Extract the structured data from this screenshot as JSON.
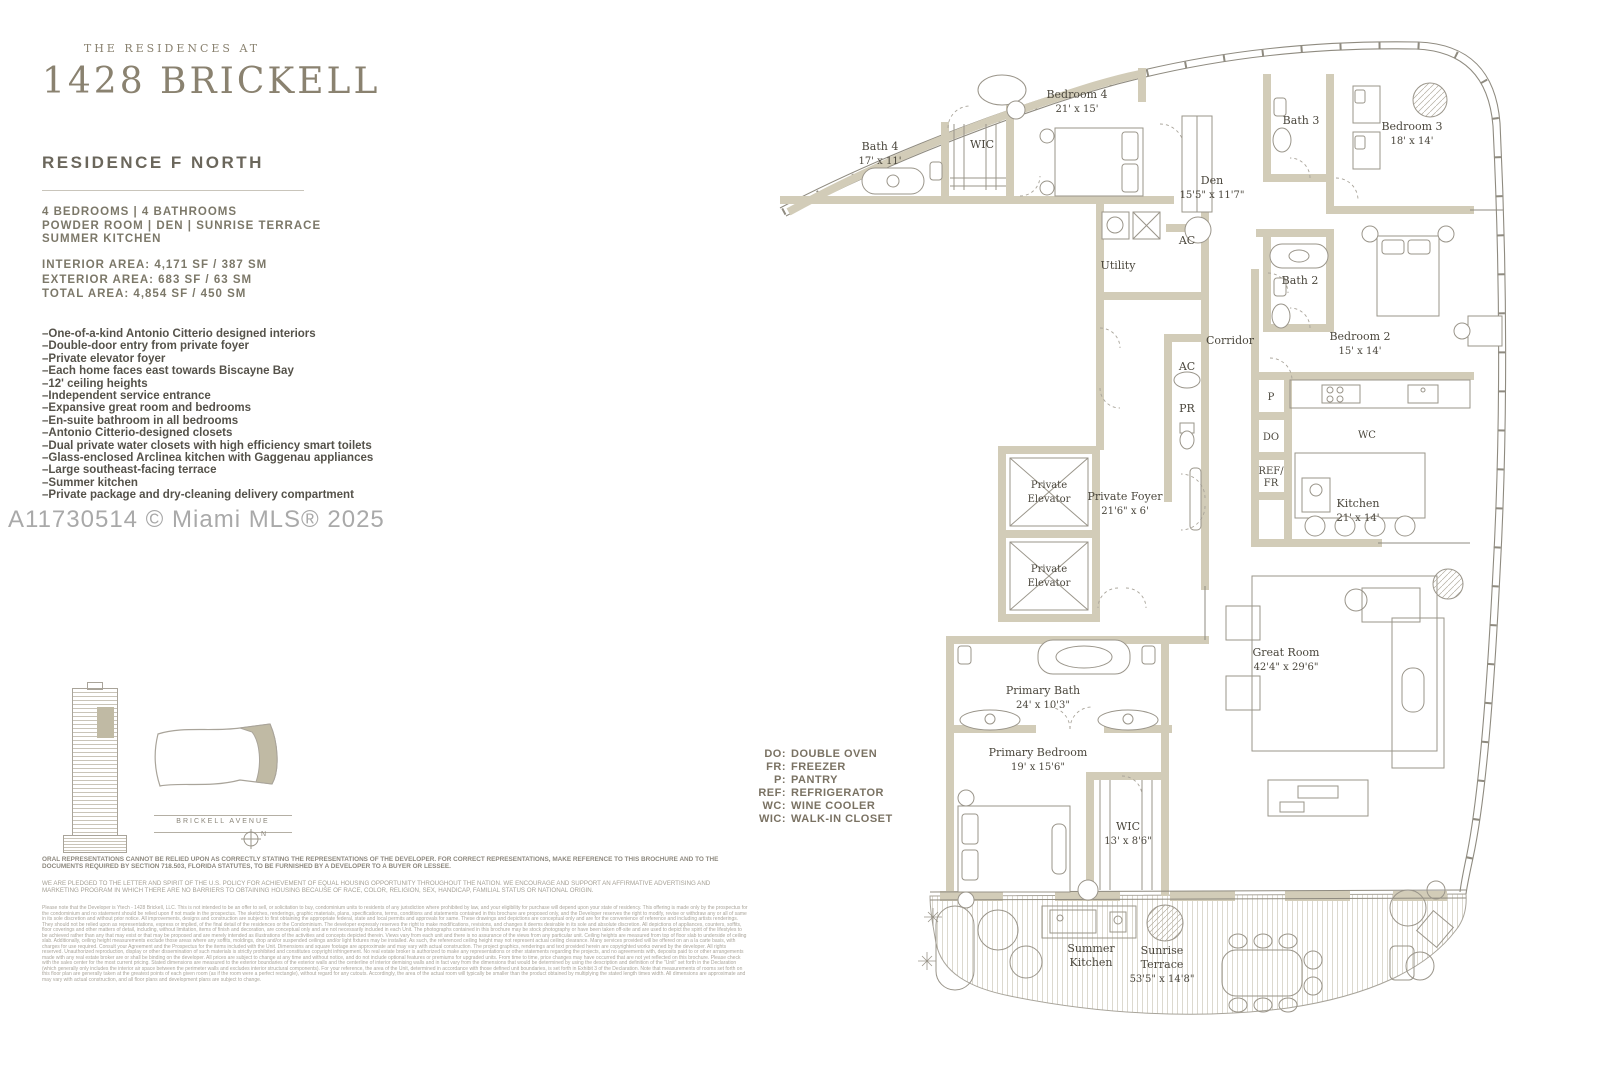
{
  "header": {
    "brand_top": "THE RESIDENCES AT",
    "brand_name": "1428 BRICKELL",
    "residence": "RESIDENCE F NORTH",
    "config_line1": "4 BEDROOMS   |   4 BATHROOMS",
    "config_line2": "POWDER ROOM   |   DEN   |   SUNRISE TERRACE",
    "config_line3": "SUMMER KITCHEN",
    "area_line1": "INTERIOR AREA: 4,171 SF / 387 SM",
    "area_line2": "EXTERIOR AREA: 683 SF / 63 SM",
    "area_line3": "TOTAL AREA: 4,854 SF / 450 SM"
  },
  "features": [
    "–One-of-a-kind Antonio Citterio designed interiors",
    "–Double-door entry from private foyer",
    "–Private elevator foyer",
    "–Each home faces east towards Biscayne Bay",
    "–12' ceiling heights",
    "–Independent service entrance",
    "–Expansive great room and bedrooms",
    "–En-suite bathroom in all bedrooms",
    "–Antonio Citterio-designed closets",
    "–Dual private water closets with high efficiency smart toilets",
    "–Glass-enclosed Arclinea kitchen with Gaggenau appliances",
    "–Large southeast-facing terrace",
    "–Summer kitchen",
    "–Private package and dry-cleaning delivery compartment"
  ],
  "watermark": "A11730514 © Miami MLS® 2025",
  "key_plan": {
    "street": "BRICKELL AVENUE",
    "compass": "N"
  },
  "legend": {
    "items": [
      {
        "abbr": "DO:",
        "label": "DOUBLE OVEN"
      },
      {
        "abbr": "FR:",
        "label": "FREEZER"
      },
      {
        "abbr": "P:",
        "label": "PANTRY"
      },
      {
        "abbr": "REF:",
        "label": "REFRIGERATOR"
      },
      {
        "abbr": "WC:",
        "label": "WINE COOLER"
      },
      {
        "abbr": "WIC:",
        "label": "WALK-IN CLOSET"
      }
    ]
  },
  "plan": {
    "rooms": {
      "bath4": {
        "name": "Bath 4",
        "dims": "17' x 11'"
      },
      "wic4": {
        "name": "WIC"
      },
      "bedroom4": {
        "name": "Bedroom 4",
        "dims": "21' x 15'"
      },
      "den": {
        "name": "Den",
        "dims": "15'5\" x 11'7\""
      },
      "bath3": {
        "name": "Bath 3"
      },
      "bedroom3": {
        "name": "Bedroom 3",
        "dims": "18' x 14'"
      },
      "utility": {
        "name": "Utility"
      },
      "ac1": {
        "name": "AC"
      },
      "bath2": {
        "name": "Bath 2"
      },
      "bedroom2": {
        "name": "Bedroom 2",
        "dims": "15' x 14'"
      },
      "corridor": {
        "name": "Corridor"
      },
      "ac2": {
        "name": "AC"
      },
      "pr": {
        "name": "PR"
      },
      "elev1": {
        "line1": "Private",
        "line2": "Elevator"
      },
      "elev2": {
        "line1": "Private",
        "line2": "Elevator"
      },
      "foyer": {
        "name": "Private Foyer",
        "dims": "21'6\" x 6'"
      },
      "pantry": {
        "name": "P"
      },
      "do": {
        "name": "DO"
      },
      "reffr": {
        "line1": "REF/",
        "line2": "FR"
      },
      "winecooler": {
        "name": "WC"
      },
      "kitchen": {
        "name": "Kitchen",
        "dims": "21' x 14'"
      },
      "greatroom": {
        "name": "Great Room",
        "dims": "42'4\" x 29'6\""
      },
      "primarybath": {
        "name": "Primary Bath",
        "dims": "24' x 10'3\""
      },
      "primarybedroom": {
        "name": "Primary Bedroom",
        "dims": "19' x 15'6\""
      },
      "primarywic": {
        "name": "WIC",
        "dims": "13' x 8'6\""
      },
      "summerkitchen": {
        "line1": "Summer",
        "line2": "Kitchen"
      },
      "terrace": {
        "line1": "Sunrise",
        "line2": "Terrace",
        "dims": "53'5\" x 14'8\""
      }
    }
  },
  "disclaimer": {
    "para1": "ORAL REPRESENTATIONS CANNOT BE RELIED UPON AS CORRECTLY STATING THE REPRESENTATIONS OF THE DEVELOPER. FOR CORRECT REPRESENTATIONS, MAKE REFERENCE TO THIS BROCHURE AND TO THE DOCUMENTS REQUIRED BY SECTION 718.503, FLORIDA STATUTES, TO BE FURNISHED BY A DEVELOPER TO A BUYER OR LESSEE.",
    "para2": "WE ARE PLEDGED TO THE LETTER AND SPIRIT OF THE U.S. POLICY FOR ACHIEVEMENT OF EQUAL HOUSING OPPORTUNITY THROUGHOUT THE NATION. WE ENCOURAGE AND SUPPORT AN AFFIRMATIVE ADVERTISING AND MARKETING PROGRAM IN WHICH THERE ARE NO BARRIERS TO OBTAINING HOUSING BECAUSE OF RACE, COLOR, RELIGION, SEX, HANDICAP, FAMILIAL STATUS OR NATIONAL ORIGIN.",
    "para3_intro": "Please note that the Developer is Ytech - 1428 Brickell, LLC.",
    "fine_print": "This is not intended to be an offer to sell, or solicitation to buy, condominium units to residents of any jurisdiction where prohibited by law, and your eligibility for purchase will depend upon your state of residency. This offering is made only by the prospectus for the condominium and no statement should be relied upon if not made in the prospectus. The sketches, renderings, graphic materials, plans, specifications, terms, conditions and statements contained in this brochure are proposed only, and the Developer reserves the right to modify, revise or withdraw any or all of same in its sole discretion and without prior notice. All improvements, designs and construction are subject to first obtaining the appropriate federal, state and local permits and approvals for same. These drawings and depictions are conceptual only and are for the convenience of reference and including artists renderings. They should not be relied upon as representations, express or implied, of the final detail of the residences or the Condominium. The developer expressly reserves the right to make modifications, revisions, and changes it deems desirable in its sole and absolute discretion. All depictions of appliances, counters, soffits, floor coverings and other matters of detail, including, without limitation, items of finish and decoration, are conceptual only and are not necessarily included in each Unit. The photographs contained in this brochure may be stock photography or have been taken off-site and are used to depict the spirit of the lifestyles to be achieved rather than any that may exist or that may be proposed and are merely intended as illustrations of the activities and concepts depicted therein. Views vary from each unit and there is no assurance of the views from any particular unit. Ceiling heights are measured from top of floor slab to underside of ceiling slab. Additionally, ceiling height measurements exclude those areas where any soffits, moldings, drop and/or suspended ceilings and/or light fixtures may be installed. As such, the referenced ceiling height may not represent actual ceiling clearance. Many services provided will be offered on an a la carte basis, with charges for use required. Consult your Agreement and the Prospectus for the items included with the Unit. Dimensions and square footage are approximate and may vary with actual construction. The project graphics, renderings and text provided herein are copyrighted works owned by the developer. All rights reserved. Unauthorized reproduction, display or other dissemination of such materials is strictly prohibited and constitutes copyright infringement. No real estate broker is authorized to make any representations or other statements regarding the projects, and no agreements with, deposits paid to or other arrangements made with any real estate broker are or shall be binding on the developer. All prices are subject to change at any time and without notice, and do not include optional features or premiums for upgraded units. From time to time, price changes may have occurred that are not yet reflected on this brochure. Please check with the sales center for the most current pricing. Stated dimensions are measured to the exterior boundaries of the exterior walls and the centerline of interior demising walls and in fact vary from the dimensions that would be determined by using the description and definition of the \"Unit\" set forth in the Declaration (which generally only includes the interior air space between the perimeter walls and excludes interior structural components). For your reference, the area of the Unit, determined in accordance with those defined unit boundaries, is set forth in Exhibit 3 of the Declaration. Note that measurements of rooms set forth on this floor plan are generally taken at the greatest points of each given room (as if the room were a perfect rectangle), without regard for any cutouts. Accordingly, the area of the actual room will typically be smaller than the product obtained by multiplying the stated length times width. All dimensions are approximate and may vary with actual construction, and all floor plans and development plans are subject to change."
  },
  "colors": {
    "wall": "#d2ccb8",
    "line": "#8f8b80",
    "accent": "#8a8270",
    "label": "#4b473d"
  }
}
